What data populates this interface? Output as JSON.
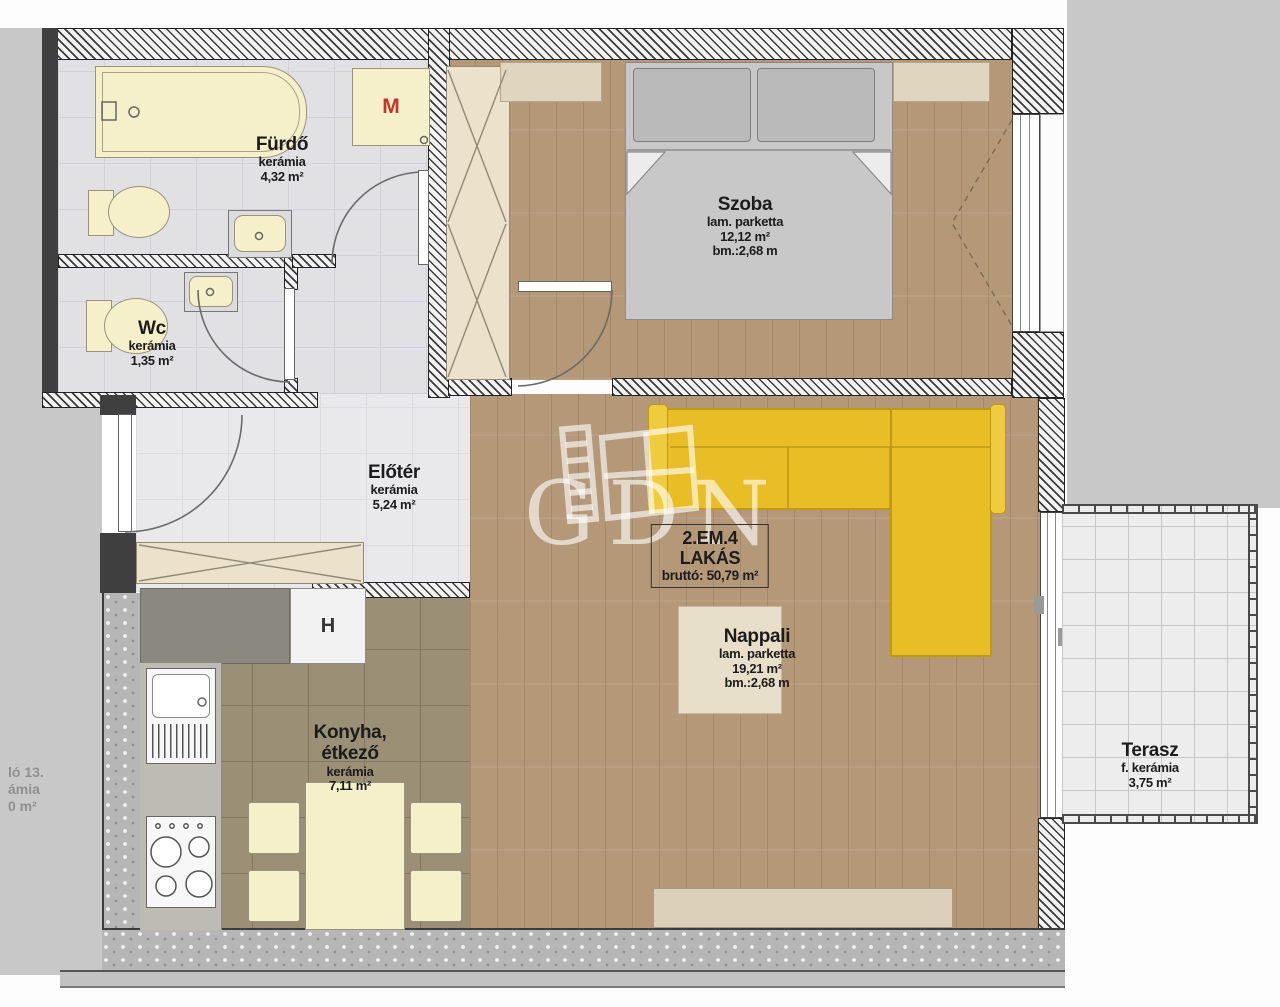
{
  "plan": {
    "watermark": {
      "text": "GDN"
    },
    "rooms": {
      "furdo": {
        "name": "Fürdő",
        "floor": "kerámia",
        "area": "4,32 m²"
      },
      "wc": {
        "name": "Wc",
        "floor": "kerámia",
        "area": "1,35 m²"
      },
      "szoba": {
        "name": "Szoba",
        "floor": "lam. parketta",
        "area": "12,12 m²",
        "height": "bm.:2,68 m"
      },
      "eloter": {
        "name": "Előtér",
        "floor": "kerámia",
        "area": "5,24 m²"
      },
      "nappali": {
        "name": "Nappali",
        "floor": "lam. parketta",
        "area": "19,21 m²",
        "height": "bm.:2,68 m"
      },
      "konyha": {
        "name1": "Konyha,",
        "name2": "étkező",
        "floor": "kerámia",
        "area": "7,11 m²"
      },
      "terasz": {
        "name": "Terasz",
        "floor": "f. kerámia",
        "area": "3,75 m²"
      }
    },
    "unit_box": {
      "line1": "2.EM.4",
      "line2": "LAKÁS",
      "line3": "bruttó: 50,79 m²"
    },
    "markers": {
      "washing_machine": "M",
      "fridge": "H"
    },
    "neighbor_fragment": {
      "line1": "ló 13.",
      "line2": "ámia",
      "line3": "0 m²"
    },
    "colors": {
      "sofa": "#e9bd25",
      "marker_m": "#c4352c",
      "marker_h": "#333333",
      "wood": "#b49878",
      "kitchen_floor": "#9b8f76",
      "watermark": "#ffffff"
    }
  }
}
